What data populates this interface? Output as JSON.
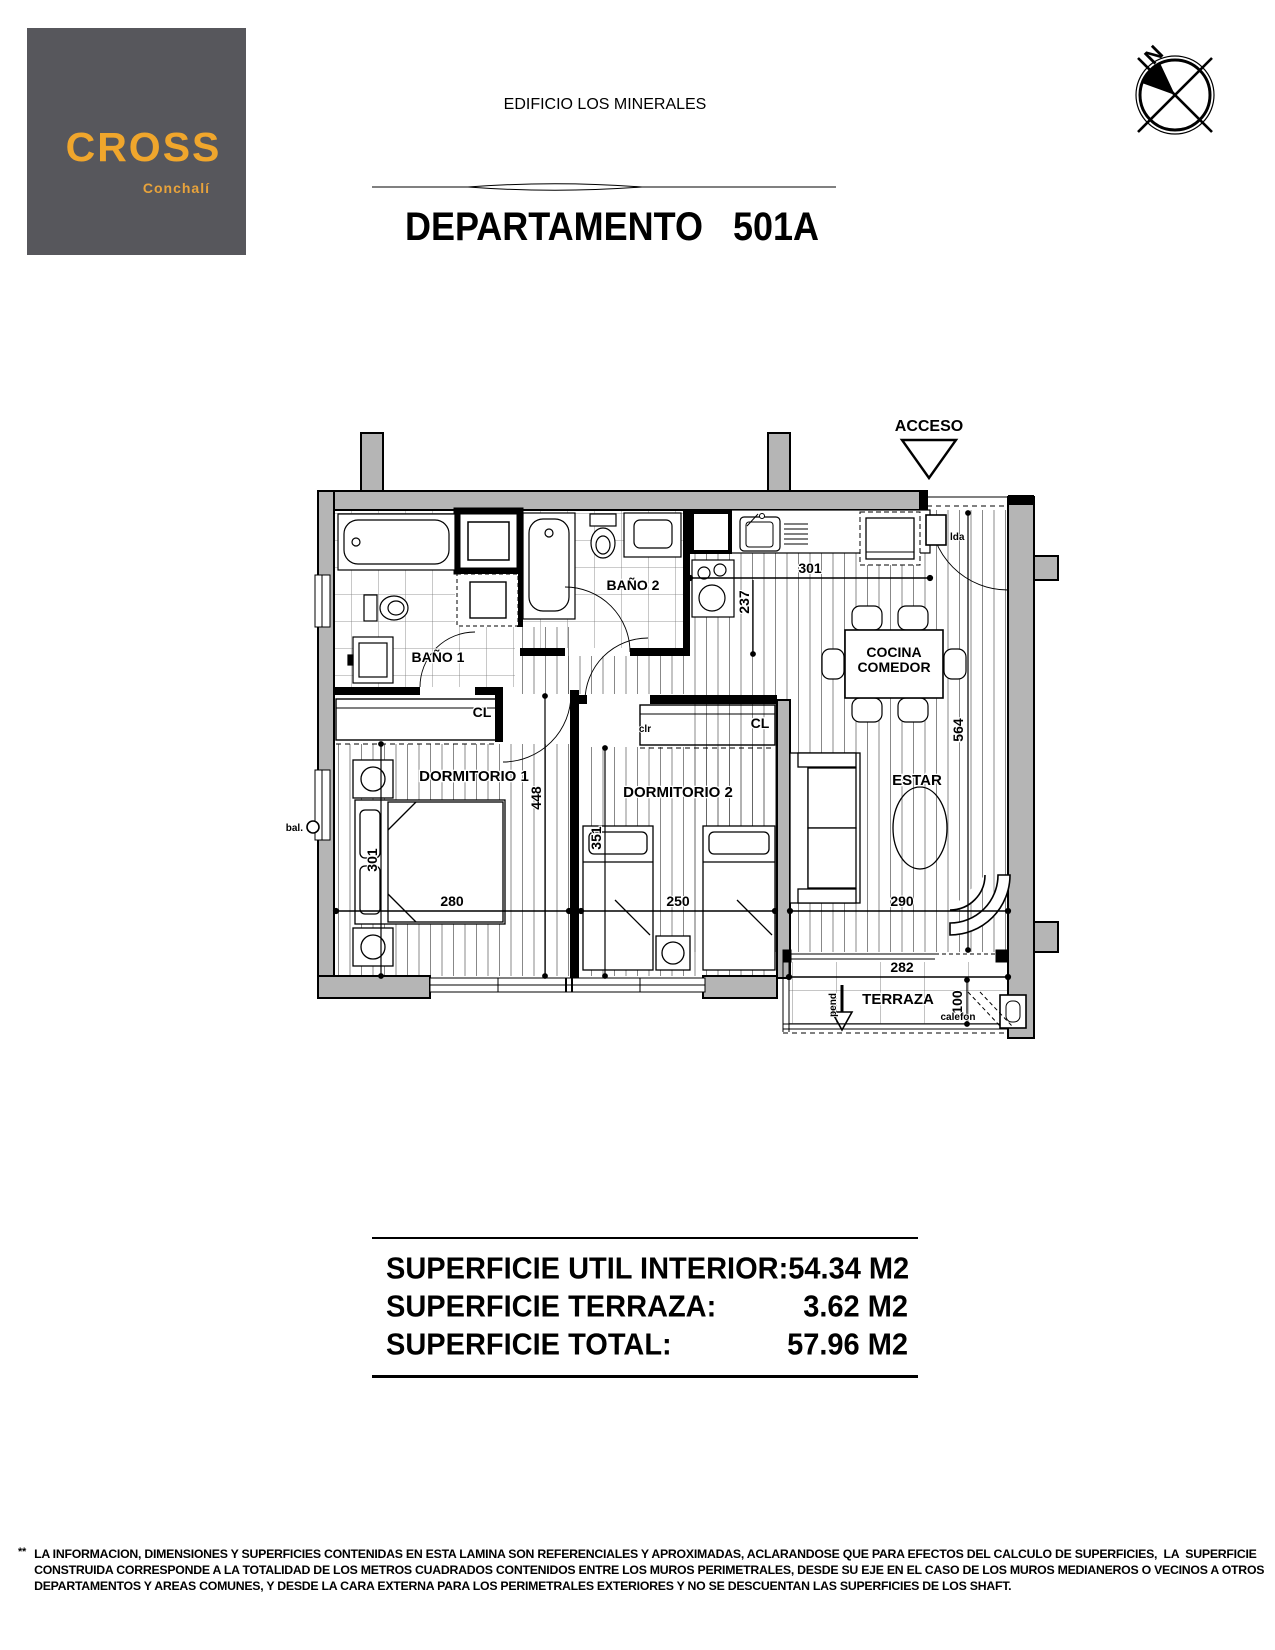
{
  "logo": {
    "brand": "CROSS",
    "location": "Conchalí",
    "bg_color": "#57575c",
    "text_color": "#f0a62c"
  },
  "header": {
    "building": "EDIFICIO  LOS MINERALES",
    "unit": "DEPARTAMENTO   501A"
  },
  "compass": {
    "north_label": "N"
  },
  "plan": {
    "access_label": "ACCESO",
    "wall_color": "#b5b5b5",
    "rooms": {
      "bano1": "BAÑO 1",
      "bano2": "BAÑO 2",
      "dorm1": "DORMITORIO 1",
      "dorm2": "DORMITORIO 2",
      "cocina_line1": "COCINA",
      "cocina_line2": "COMEDOR",
      "estar": "ESTAR",
      "terraza": "TERRAZA"
    },
    "closet_labels": {
      "dorm1": "CL",
      "dorm2": "CL"
    },
    "small_labels": {
      "lda": "lda",
      "clr": "clr",
      "bal": "bal.",
      "pend": "pend",
      "calefon": "calefon"
    },
    "dimensions": {
      "cocina_width": "301",
      "cocina_depth": "237",
      "estar_total_depth": "564",
      "estar_width": "290",
      "terraza_width": "282",
      "terraza_depth": "100",
      "dorm1_width": "280",
      "dorm1_depth": "301",
      "dorm1_total_depth": "448",
      "dorm2_depth": "351",
      "dorm2_width": "250"
    }
  },
  "surface_table": {
    "rows": [
      {
        "label": "SUPERFICIE UTIL INTERIOR:",
        "value": "54.34 M2"
      },
      {
        "label": "SUPERFICIE TERRAZA:",
        "value": "3.62 M2"
      },
      {
        "label": "SUPERFICIE TOTAL:",
        "value": "57.96 M2"
      }
    ]
  },
  "footnote": {
    "marker": "**",
    "lines": [
      "LA INFORMACION, DIMENSIONES Y SUPERFICIES CONTENIDAS EN ESTA LAMINA SON REFERENCIALES Y APROXIMADAS, ACLARANDOSE QUE PARA EFECTOS DEL CALCULO DE SUPERFICIES,  LA  SUPERFICIE",
      "CONSTRUIDA CORRESPONDE A LA TOTALIDAD DE LOS METROS CUADRADOS CONTENIDOS ENTRE LOS MUROS PERIMETRALES, DESDE SU EJE EN EL CASO DE LOS MUROS MEDIANEROS O VECINOS A OTROS",
      "DEPARTAMENTOS Y AREAS COMUNES, Y DESDE LA CARA EXTERNA PARA LOS PERIMETRALES EXTERIORES Y NO SE DESCUENTAN LAS SUPERFICIES DE LOS SHAFT."
    ]
  }
}
